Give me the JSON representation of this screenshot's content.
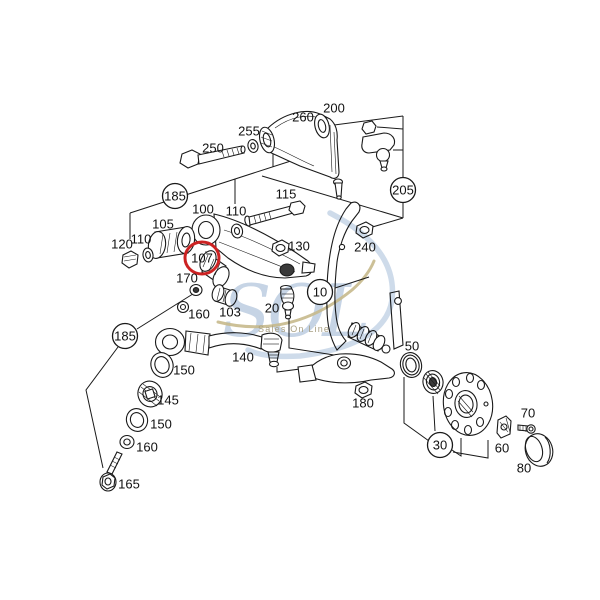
{
  "diagram": {
    "type": "exploded-parts-diagram",
    "subject": "front suspension",
    "line_color": "#1a1a1a",
    "highlight_color": "#cc2222",
    "part_labels": [
      {
        "part": "250",
        "x": 213,
        "y": 148,
        "shape": "plain"
      },
      {
        "part": "255",
        "x": 249,
        "y": 131,
        "shape": "plain"
      },
      {
        "part": "260",
        "x": 303,
        "y": 117,
        "shape": "plain"
      },
      {
        "part": "200",
        "x": 334,
        "y": 108,
        "shape": "plain"
      },
      {
        "part": "205",
        "x": 403,
        "y": 190,
        "shape": "circle"
      },
      {
        "part": "185",
        "x": 175,
        "y": 196,
        "shape": "circle"
      },
      {
        "part": "100",
        "x": 203,
        "y": 209,
        "shape": "plain"
      },
      {
        "part": "110",
        "x": 236,
        "y": 211,
        "shape": "plain"
      },
      {
        "part": "115",
        "x": 286,
        "y": 194,
        "shape": "plain"
      },
      {
        "part": "105",
        "x": 163,
        "y": 224,
        "shape": "plain"
      },
      {
        "part": "110",
        "x": 141,
        "y": 239,
        "shape": "plain"
      },
      {
        "part": "120",
        "x": 122,
        "y": 244,
        "shape": "plain"
      },
      {
        "part": "107",
        "x": 202,
        "y": 258,
        "shape": "highlight-circle"
      },
      {
        "part": "130",
        "x": 299,
        "y": 246,
        "shape": "plain"
      },
      {
        "part": "170",
        "x": 187,
        "y": 278,
        "shape": "plain"
      },
      {
        "part": "160",
        "x": 199,
        "y": 314,
        "shape": "plain"
      },
      {
        "part": "103",
        "x": 230,
        "y": 312,
        "shape": "plain"
      },
      {
        "part": "20",
        "x": 272,
        "y": 308,
        "shape": "plain"
      },
      {
        "part": "10",
        "x": 320,
        "y": 292,
        "shape": "circle"
      },
      {
        "part": "240",
        "x": 365,
        "y": 247,
        "shape": "plain"
      },
      {
        "part": "185",
        "x": 125,
        "y": 336,
        "shape": "circle"
      },
      {
        "part": "140",
        "x": 243,
        "y": 357,
        "shape": "plain"
      },
      {
        "part": "150",
        "x": 184,
        "y": 370,
        "shape": "plain"
      },
      {
        "part": "145",
        "x": 168,
        "y": 400,
        "shape": "plain"
      },
      {
        "part": "150",
        "x": 161,
        "y": 424,
        "shape": "plain"
      },
      {
        "part": "160",
        "x": 147,
        "y": 447,
        "shape": "plain"
      },
      {
        "part": "165",
        "x": 129,
        "y": 484,
        "shape": "plain"
      },
      {
        "part": "180",
        "x": 363,
        "y": 403,
        "shape": "plain"
      },
      {
        "part": "50",
        "x": 412,
        "y": 346,
        "shape": "plain"
      },
      {
        "part": "30",
        "x": 440,
        "y": 445,
        "shape": "circle"
      },
      {
        "part": "60",
        "x": 502,
        "y": 448,
        "shape": "plain"
      },
      {
        "part": "70",
        "x": 528,
        "y": 413,
        "shape": "plain"
      },
      {
        "part": "80",
        "x": 524,
        "y": 468,
        "shape": "plain"
      }
    ]
  },
  "watermark": {
    "logo_text": "SOL",
    "tagline": "Sales On Line",
    "logo_color": "#c3d2e4",
    "tagline_color": "#a89f82",
    "swoosh_gold_color": "#c7b98c",
    "swoosh_blue_color": "#c9d7e8"
  }
}
